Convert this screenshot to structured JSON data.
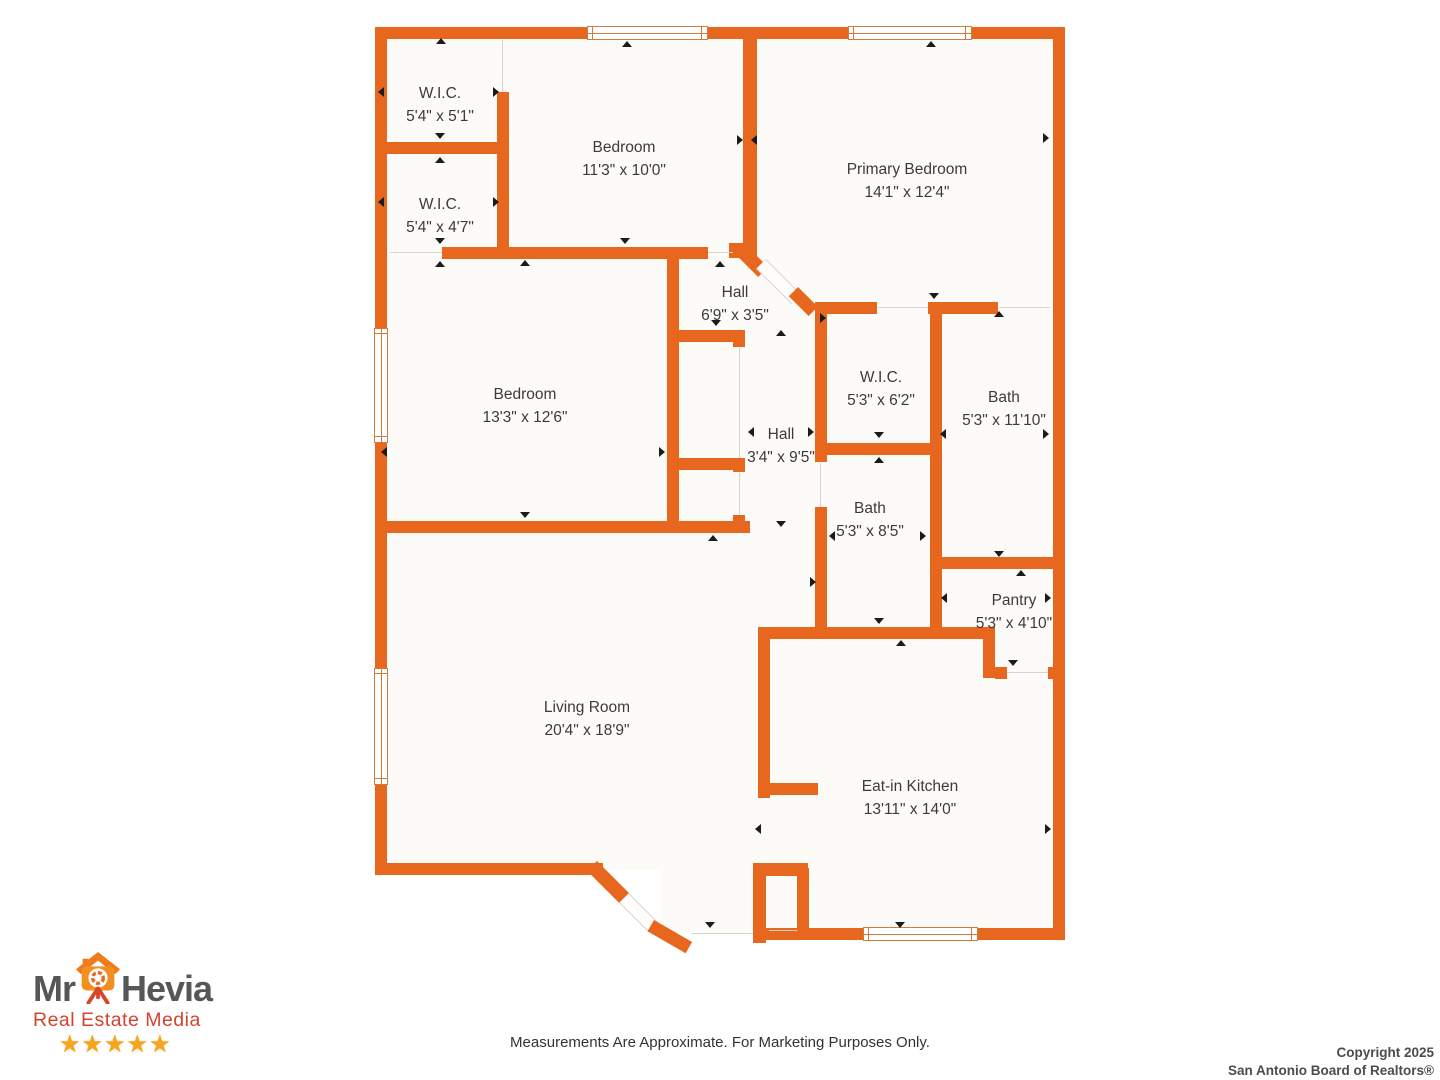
{
  "floor_plan": {
    "wall_color": "#e8671e",
    "rooms": [
      {
        "name": "W.I.C.",
        "dims": "5'4\" x 5'1\""
      },
      {
        "name": "Bedroom",
        "dims": "11'3\" x 10'0\""
      },
      {
        "name": "Primary Bedroom",
        "dims": "14'1\" x 12'4\""
      },
      {
        "name": "W.I.C.",
        "dims": "5'4\" x 4'7\""
      },
      {
        "name": "Bedroom",
        "dims": "13'3\" x 12'6\""
      },
      {
        "name": "Hall",
        "dims": "6'9\" x 3'5\""
      },
      {
        "name": "W.I.C.",
        "dims": "5'3\" x 6'2\""
      },
      {
        "name": "Bath",
        "dims": "5'3\" x 11'10\""
      },
      {
        "name": "Hall",
        "dims": "3'4\" x 9'5\""
      },
      {
        "name": "Bath",
        "dims": "5'3\" x 8'5\""
      },
      {
        "name": "Pantry",
        "dims": "5'3\" x 4'10\""
      },
      {
        "name": "Living Room",
        "dims": "20'4\" x 18'9\""
      },
      {
        "name": "Eat-in Kitchen",
        "dims": "13'11\" x 14'0\""
      }
    ],
    "disclaimer": "Measurements Are Approximate. For Marketing Purposes Only."
  },
  "logo": {
    "brand_first": "Mr",
    "brand_last": "Hevia",
    "tagline": "Real Estate Media",
    "stars": "★★★★★",
    "brand_color": "#57575a",
    "tagline_color": "#d2442e",
    "star_color": "#f6a51c"
  },
  "copyright": {
    "line1": "Copyright 2025",
    "line2": "San Antonio Board of Realtors®"
  }
}
